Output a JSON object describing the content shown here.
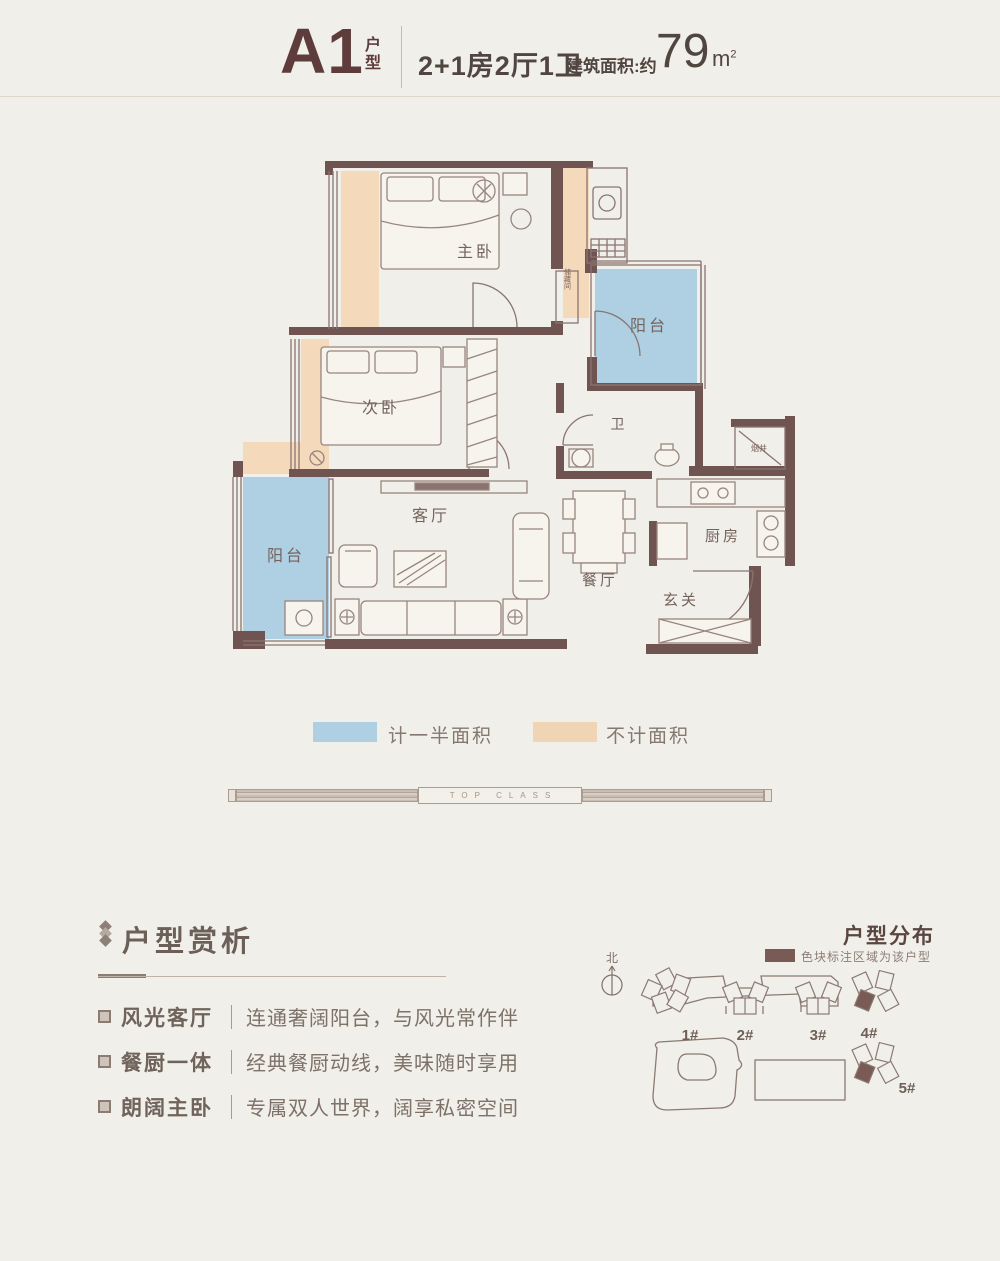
{
  "header": {
    "unit_code": "A1",
    "unit_code_suffix": "户型",
    "layout_spec": "2+1房2厅1卫",
    "area_label": "建筑面积:约",
    "area_value": "79",
    "area_unit_base": "m",
    "area_unit_exponent": "2"
  },
  "floorplan": {
    "rooms": {
      "master_bedroom": "主卧",
      "second_bedroom": "次卧",
      "balcony_upper": "阳台",
      "balcony_lower": "阳台",
      "bathroom": "卫",
      "living_room": "客厅",
      "dining_room": "餐厅",
      "kitchen": "厨房",
      "foyer": "玄关",
      "storage": "储藏间",
      "flue": "烟井"
    }
  },
  "legend": {
    "items": [
      {
        "swatch_color": "#aed0e2",
        "label": "计一半面积"
      },
      {
        "swatch_color": "#f0d5b4",
        "label": "不计面积"
      }
    ]
  },
  "divider": {
    "text": "TOP CLASS"
  },
  "analysis": {
    "title": "户型赏析",
    "items": [
      {
        "term": "风光客厅",
        "desc": "连通奢阔阳台，与风光常作伴"
      },
      {
        "term": "餐厨一体",
        "desc": "经典餐厨动线，美味随时享用"
      },
      {
        "term": "朗阔主卧",
        "desc": "专属双人世界，阔享私密空间"
      }
    ]
  },
  "distribution": {
    "title": "户型分布",
    "legend_note": "色块标注区域为该户型",
    "north_label": "北",
    "building_labels": [
      "1#",
      "2#",
      "3#",
      "4#",
      "5#"
    ]
  },
  "colors": {
    "background": "#f1efe9",
    "wall": "#6f5452",
    "accent_maroon": "#5e3c3c",
    "half_area_fill": "#aed0e2",
    "excluded_fill": "#f0d5b4",
    "highlight_building": "#7a5a55"
  }
}
